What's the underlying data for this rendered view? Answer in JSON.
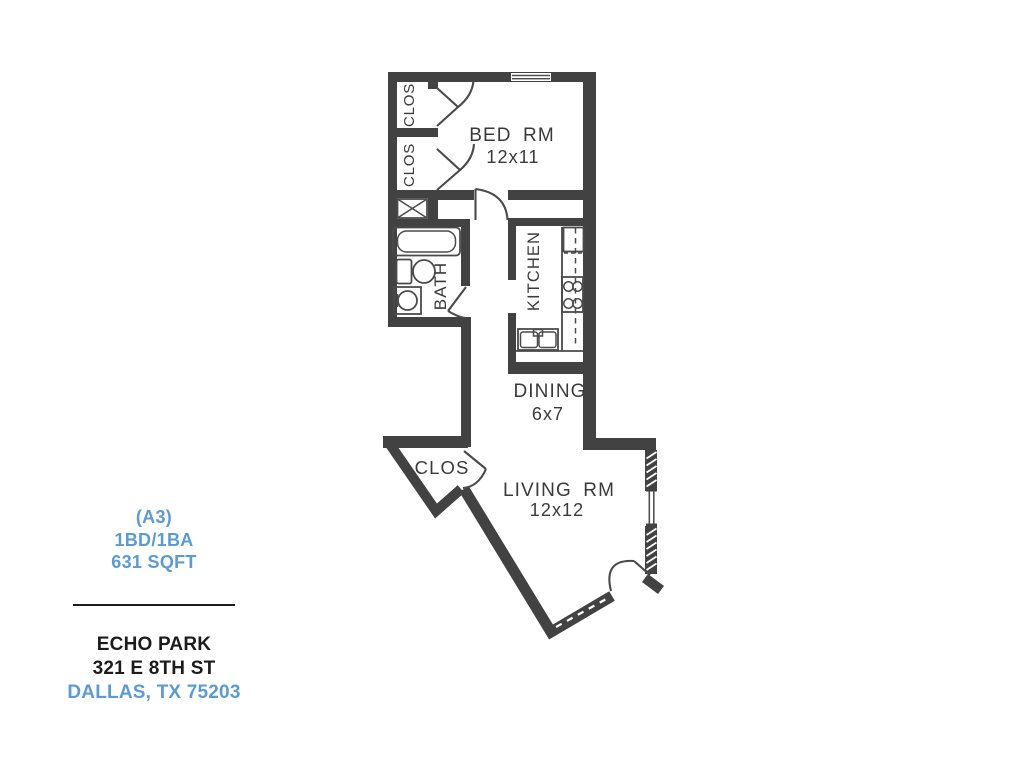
{
  "info_panel": {
    "unit_code": "(A3)",
    "unit_type": "1BD/1BA",
    "unit_area": "631 SQFT",
    "property_name": "ECHO PARK",
    "address": "321 E 8TH ST",
    "city_state_zip": "DALLAS, TX 75203",
    "accent_color": "#5B9BD5"
  },
  "floor_plan": {
    "wall_color": "#424242",
    "rooms": {
      "bedroom": {
        "label": "BED RM",
        "dims": "12x11"
      },
      "kitchen": {
        "label": "KITCHEN",
        "dims": ""
      },
      "dining": {
        "label": "DINING",
        "dims": "6x7"
      },
      "living": {
        "label": "LIVING RM",
        "dims": "12x12"
      },
      "bath": {
        "label": "BATH",
        "dims": ""
      },
      "closet1": {
        "label": "CLOS"
      },
      "closet2": {
        "label": "CLOS"
      },
      "entry_closet": {
        "label": "CLOS"
      }
    },
    "fixtures": [
      "bathtub",
      "toilet",
      "vanity-sink",
      "water-heater",
      "refrigerator",
      "range-4-burner",
      "double-sink",
      "counter",
      "upper-cabinets-dashed"
    ],
    "openings": [
      "bedroom-window",
      "living-window",
      "entry-door",
      "bedroom-door",
      "bath-door",
      "closet-bifold-1",
      "closet-bifold-2",
      "entry-closet-door",
      "patio-slider"
    ]
  }
}
